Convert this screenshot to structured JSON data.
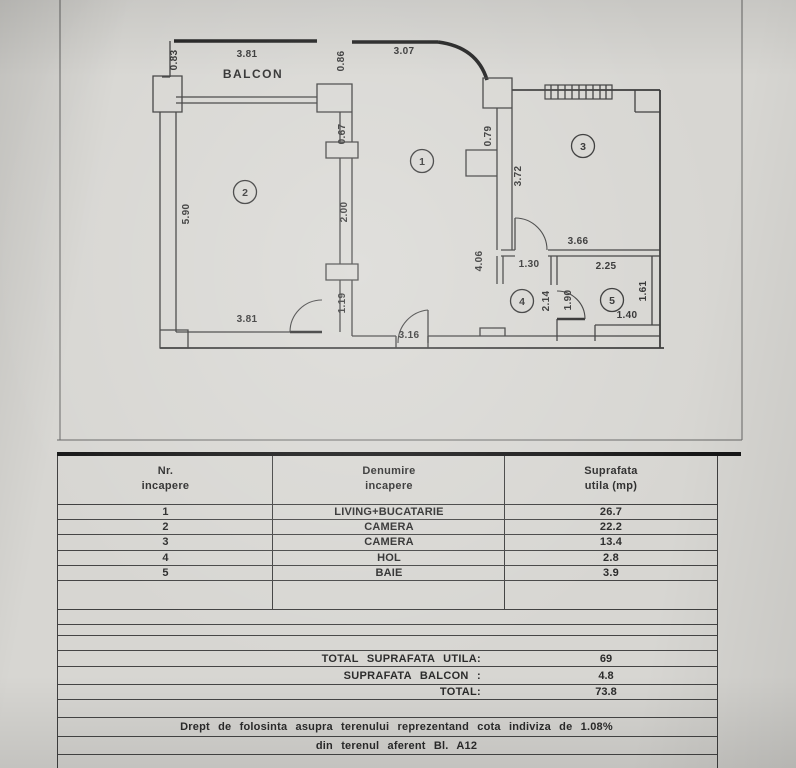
{
  "page": {
    "background": "#d7d6d2",
    "line_color": "#3a3a3a",
    "accent_black": "#161616"
  },
  "floor_plan": {
    "balcony_label": "BALCON",
    "rooms": [
      {
        "number": "1",
        "x": 422,
        "y": 161
      },
      {
        "number": "2",
        "x": 245,
        "y": 192
      },
      {
        "number": "3",
        "x": 583,
        "y": 146
      },
      {
        "number": "4",
        "x": 522,
        "y": 301
      },
      {
        "number": "5",
        "x": 612,
        "y": 300
      }
    ],
    "dimensions": [
      {
        "text": "0.83",
        "x": 177,
        "y": 60,
        "rotated": true
      },
      {
        "text": "3.81",
        "x": 247,
        "y": 57,
        "rotated": false
      },
      {
        "text": "0.86",
        "x": 344,
        "y": 61,
        "rotated": true
      },
      {
        "text": "3.07",
        "x": 404,
        "y": 54,
        "rotated": false
      },
      {
        "text": "0.67",
        "x": 345,
        "y": 134,
        "rotated": true
      },
      {
        "text": "0.79",
        "x": 491,
        "y": 136,
        "rotated": true
      },
      {
        "text": "3.72",
        "x": 521,
        "y": 176,
        "rotated": true
      },
      {
        "text": "5.90",
        "x": 189,
        "y": 214,
        "rotated": true
      },
      {
        "text": "2.00",
        "x": 347,
        "y": 212,
        "rotated": true
      },
      {
        "text": "3.66",
        "x": 578,
        "y": 244,
        "rotated": false
      },
      {
        "text": "4.06",
        "x": 482,
        "y": 261,
        "rotated": true
      },
      {
        "text": "1.30",
        "x": 529,
        "y": 267,
        "rotated": false
      },
      {
        "text": "2.25",
        "x": 606,
        "y": 269,
        "rotated": false
      },
      {
        "text": "2.14",
        "x": 549,
        "y": 301,
        "rotated": true
      },
      {
        "text": "1.90",
        "x": 571,
        "y": 300,
        "rotated": true
      },
      {
        "text": "1.61",
        "x": 646,
        "y": 291,
        "rotated": true
      },
      {
        "text": "1.40",
        "x": 627,
        "y": 318,
        "rotated": false
      },
      {
        "text": "1.19",
        "x": 345,
        "y": 303,
        "rotated": true
      },
      {
        "text": "3.81",
        "x": 247,
        "y": 322,
        "rotated": false
      },
      {
        "text": "3.16",
        "x": 409,
        "y": 338,
        "rotated": false
      }
    ]
  },
  "table": {
    "headers": [
      {
        "line1": "Nr.",
        "line2": "incapere"
      },
      {
        "line1": "Denumire",
        "line2": "incapere"
      },
      {
        "line1": "Suprafata",
        "line2": "utila  (mp)"
      }
    ],
    "rows": [
      {
        "nr": "1",
        "name": "LIVING+BUCATARIE",
        "area": "26.7"
      },
      {
        "nr": "2",
        "name": "CAMERA",
        "area": "22.2"
      },
      {
        "nr": "3",
        "name": "CAMERA",
        "area": "13.4"
      },
      {
        "nr": "4",
        "name": "HOL",
        "area": "2.8"
      },
      {
        "nr": "5",
        "name": "BAIE",
        "area": "3.9"
      }
    ],
    "totals": [
      {
        "label": "TOTAL  SUPRAFATA  UTILA:",
        "value": "69"
      },
      {
        "label": "SUPRAFATA  BALCON :",
        "value": "4.8"
      },
      {
        "label": "TOTAL:",
        "value": "73.8"
      }
    ],
    "note_line1": "Drept  de  folosinta  asupra  terenului  reprezentand  cota  indiviza  de  1.08%",
    "note_line2": "din  terenul  aferent  Bl.  A12"
  }
}
